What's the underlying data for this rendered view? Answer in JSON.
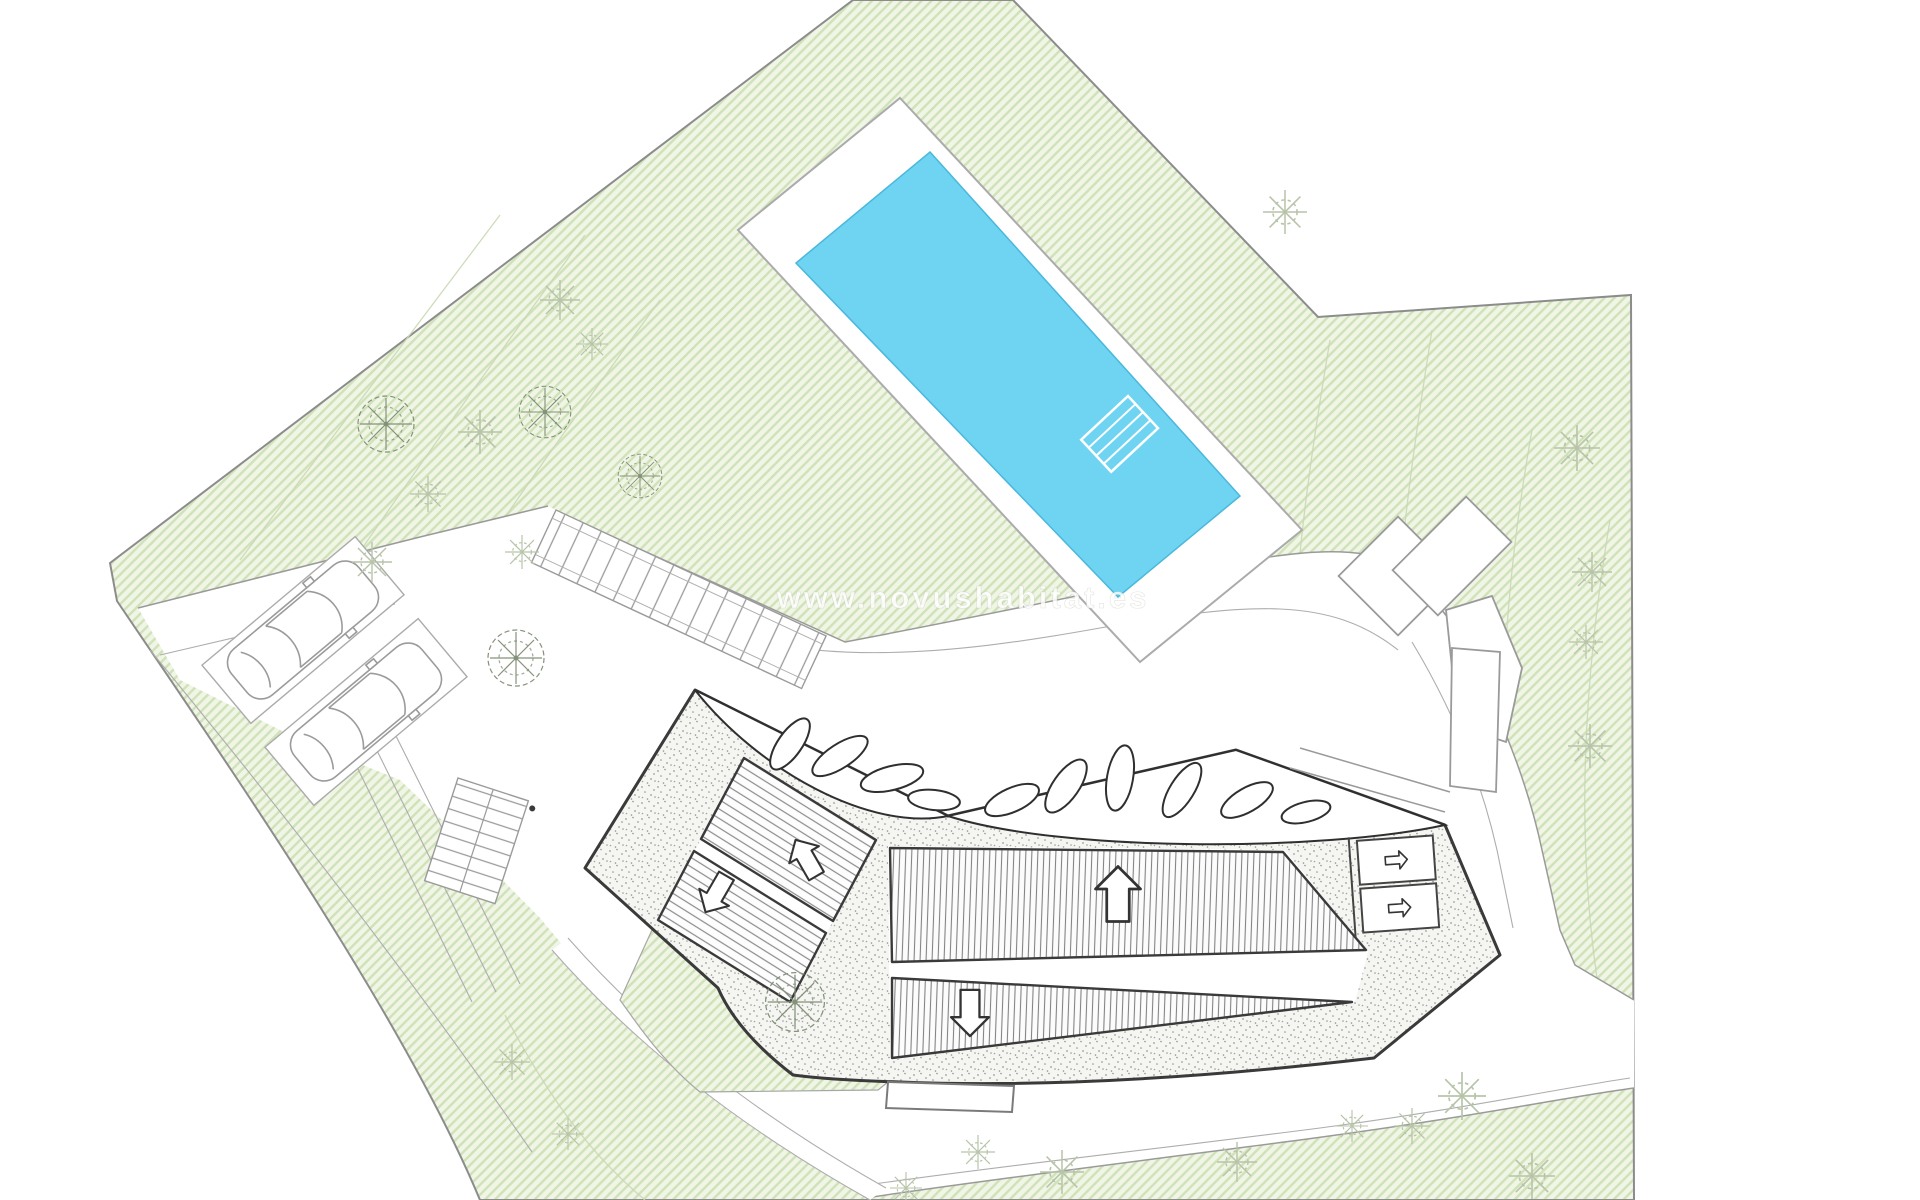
{
  "watermark": {
    "text": "www.novushabitat.es"
  },
  "drawing": {
    "type": "architectural-site-plan",
    "features": {
      "plot": "hatched green garden parcel",
      "pool": "rotated rectangular swimming pool with white deck and corner steps",
      "building": "angular villa roof plan with gravel border, slatted roof decks and leaf-shaped skylights",
      "parking_spaces": 2,
      "walkways": "stepped ramp, stair flight and curved perimeter roads",
      "trees_detailed": 5,
      "trees_sketched": 20
    }
  },
  "icons": {
    "slope_arrow_up": "hollow block arrow pointing up (roof slope)",
    "slope_arrow_down": "hollow block arrow pointing down (roof slope)",
    "entry_arrow_right": "small right arrow (entrance/stair direction)"
  },
  "colors": {
    "background": "#ffffff",
    "site_green_base": "#f0f5e6",
    "site_green_stripe": "#cfe2b8",
    "boundary_gray": "#8c8c8c",
    "paving_white": "#ffffff",
    "line_gray": "#9a9a9a",
    "building_outline": "#3a3a3a",
    "pool_water": "#6fd4f1",
    "pool_water_edge": "#49b8dc",
    "tree_detailed": "#84927a",
    "tree_faint": "#b7c4a8",
    "watermark_color": "rgba(255,255,255,0.82)"
  }
}
